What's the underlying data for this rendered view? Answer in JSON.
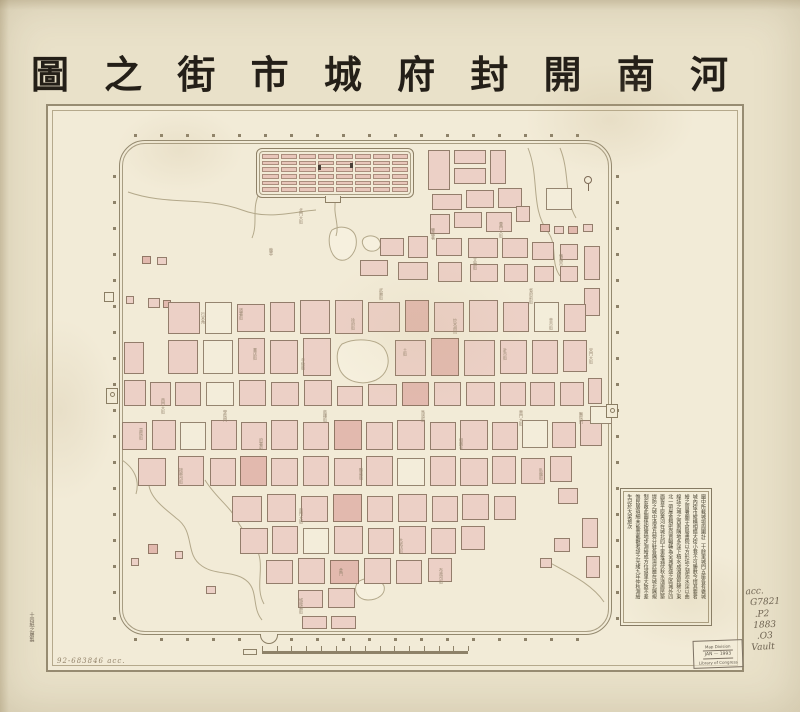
{
  "title": {
    "text": "河南開封府城市街之圖",
    "display": "圖 之 街 市 城 府 封 開 南 河"
  },
  "annotations": {
    "accession": "92-683846   acc.",
    "maker_note": "十四紙之屠製",
    "catalog": [
      "acc.",
      "G7821",
      ".P2",
      "1883",
      ".O3",
      "Vault"
    ]
  },
  "stamp": {
    "line1": "Map Division",
    "line2": "JAN — 1993",
    "line3": "Library of Congress"
  },
  "colors": {
    "sheet": "#e9e1c9",
    "map_paper": "#f2ebd7",
    "frame": "#978c72",
    "wall": "#93886e",
    "block_pink": "#ecd0c6",
    "block_dark": "#e2b9ae",
    "water": "#b3a88a",
    "ink": "#241f18",
    "pencil": "#6e6352"
  },
  "legend": {
    "columns": [
      "圖中所載城垣周圍計二十餘里城門五座各有甕城",
      "城內街市縱橫相錯大街小巷不可勝數今擇其要者",
      "繪之官署廟宇倉局書院以方形誌之湖池水窪以曲",
      "線誌之城之西南隅地多窪下積水成湖居民稀少東",
      "北一帶屋舍稠密商賈輻輳為全城繁盛之區城外四",
      "面皆平原黃河在城北四十里每遇伏秋水漲居民築",
      "堤防之城中滿漢兵營分駐各隅演武廳在城北隅規",
      "制宏敞此圖係按實地步測繪成方位道里大致不差",
      "惟民居瑣細未能悉載觀者諒之光緒九年仲秋測繪",
      "生記於大梁旅次"
    ]
  },
  "map": {
    "blocks": [
      [
        428,
        150,
        22,
        40
      ],
      [
        454,
        150,
        32,
        14
      ],
      [
        454,
        168,
        32,
        16
      ],
      [
        490,
        150,
        16,
        34
      ],
      [
        432,
        194,
        30,
        16
      ],
      [
        466,
        190,
        28,
        18
      ],
      [
        498,
        188,
        24,
        20
      ],
      [
        454,
        212,
        28,
        16
      ],
      [
        430,
        214,
        20,
        20
      ],
      [
        486,
        212,
        26,
        20
      ],
      [
        516,
        206,
        14,
        16
      ],
      [
        540,
        224,
        10,
        8,
        1
      ],
      [
        554,
        226,
        10,
        8
      ],
      [
        568,
        226,
        10,
        8,
        1
      ],
      [
        583,
        224,
        10,
        8
      ],
      [
        546,
        188,
        26,
        22,
        2
      ],
      [
        380,
        238,
        24,
        18
      ],
      [
        408,
        236,
        20,
        22
      ],
      [
        360,
        260,
        28,
        16
      ],
      [
        398,
        262,
        30,
        18
      ],
      [
        436,
        238,
        26,
        18
      ],
      [
        438,
        262,
        24,
        20
      ],
      [
        468,
        238,
        30,
        20
      ],
      [
        470,
        264,
        28,
        18
      ],
      [
        502,
        238,
        26,
        20
      ],
      [
        504,
        264,
        24,
        18
      ],
      [
        532,
        242,
        22,
        18
      ],
      [
        534,
        266,
        20,
        16
      ],
      [
        560,
        244,
        18,
        16
      ],
      [
        560,
        266,
        18,
        16
      ],
      [
        584,
        246,
        16,
        34
      ],
      [
        584,
        288,
        16,
        28
      ],
      [
        142,
        256,
        9,
        8,
        1
      ],
      [
        157,
        257,
        10,
        8
      ],
      [
        126,
        296,
        8,
        8
      ],
      [
        148,
        298,
        12,
        10
      ],
      [
        163,
        300,
        8,
        8,
        1
      ],
      [
        168,
        302,
        32,
        32
      ],
      [
        205,
        302,
        27,
        32,
        2
      ],
      [
        237,
        304,
        28,
        28
      ],
      [
        270,
        302,
        25,
        30
      ],
      [
        300,
        300,
        30,
        34
      ],
      [
        335,
        300,
        28,
        34
      ],
      [
        368,
        302,
        32,
        30
      ],
      [
        405,
        300,
        24,
        32,
        1
      ],
      [
        434,
        302,
        30,
        30
      ],
      [
        469,
        300,
        29,
        32
      ],
      [
        503,
        302,
        26,
        30
      ],
      [
        534,
        302,
        25,
        30,
        2
      ],
      [
        564,
        304,
        22,
        28
      ],
      [
        168,
        340,
        30,
        34
      ],
      [
        203,
        340,
        30,
        34,
        2
      ],
      [
        238,
        338,
        27,
        36
      ],
      [
        270,
        340,
        28,
        34
      ],
      [
        303,
        338,
        28,
        38
      ],
      [
        395,
        340,
        31,
        36
      ],
      [
        431,
        338,
        28,
        38,
        1
      ],
      [
        464,
        340,
        31,
        36
      ],
      [
        500,
        340,
        27,
        34
      ],
      [
        532,
        340,
        26,
        34
      ],
      [
        563,
        340,
        24,
        32
      ],
      [
        124,
        342,
        20,
        32
      ],
      [
        124,
        380,
        22,
        26
      ],
      [
        150,
        382,
        21,
        24
      ],
      [
        175,
        382,
        26,
        24
      ],
      [
        206,
        382,
        28,
        24,
        2
      ],
      [
        239,
        380,
        27,
        26
      ],
      [
        271,
        382,
        28,
        24
      ],
      [
        304,
        380,
        28,
        26
      ],
      [
        337,
        386,
        26,
        20
      ],
      [
        368,
        384,
        29,
        22
      ],
      [
        402,
        382,
        27,
        24,
        1
      ],
      [
        434,
        382,
        27,
        24
      ],
      [
        466,
        382,
        29,
        24
      ],
      [
        500,
        382,
        26,
        24
      ],
      [
        530,
        382,
        25,
        24
      ],
      [
        560,
        382,
        24,
        24
      ],
      [
        588,
        378,
        14,
        26
      ],
      [
        122,
        422,
        25,
        28
      ],
      [
        152,
        420,
        24,
        30
      ],
      [
        180,
        422,
        26,
        28,
        2
      ],
      [
        211,
        420,
        26,
        30
      ],
      [
        241,
        422,
        26,
        28
      ],
      [
        271,
        420,
        27,
        30
      ],
      [
        303,
        422,
        26,
        28
      ],
      [
        334,
        420,
        28,
        30,
        1
      ],
      [
        366,
        422,
        27,
        28
      ],
      [
        397,
        420,
        28,
        30
      ],
      [
        430,
        422,
        26,
        28
      ],
      [
        460,
        420,
        28,
        30
      ],
      [
        492,
        422,
        26,
        28
      ],
      [
        522,
        420,
        26,
        28,
        2
      ],
      [
        552,
        422,
        24,
        26
      ],
      [
        580,
        420,
        22,
        26
      ],
      [
        138,
        458,
        28,
        28
      ],
      [
        178,
        456,
        26,
        30
      ],
      [
        210,
        458,
        26,
        28
      ],
      [
        240,
        456,
        27,
        30,
        1
      ],
      [
        271,
        458,
        27,
        28
      ],
      [
        303,
        456,
        26,
        30
      ],
      [
        334,
        458,
        28,
        28
      ],
      [
        366,
        456,
        27,
        30
      ],
      [
        397,
        458,
        28,
        28,
        2
      ],
      [
        430,
        456,
        26,
        30
      ],
      [
        460,
        458,
        28,
        28
      ],
      [
        492,
        456,
        24,
        28
      ],
      [
        521,
        458,
        24,
        26
      ],
      [
        550,
        456,
        22,
        26
      ],
      [
        232,
        496,
        30,
        26
      ],
      [
        267,
        494,
        29,
        28
      ],
      [
        301,
        496,
        27,
        26
      ],
      [
        333,
        494,
        29,
        28,
        1
      ],
      [
        367,
        496,
        26,
        26
      ],
      [
        398,
        494,
        29,
        28
      ],
      [
        432,
        496,
        26,
        26
      ],
      [
        462,
        494,
        27,
        26
      ],
      [
        494,
        496,
        22,
        24
      ],
      [
        240,
        528,
        28,
        26
      ],
      [
        272,
        526,
        26,
        28
      ],
      [
        303,
        528,
        26,
        26,
        2
      ],
      [
        334,
        526,
        29,
        28
      ],
      [
        368,
        528,
        26,
        26
      ],
      [
        399,
        526,
        27,
        28
      ],
      [
        431,
        528,
        25,
        26
      ],
      [
        461,
        526,
        24,
        24
      ],
      [
        266,
        560,
        27,
        24
      ],
      [
        298,
        558,
        27,
        26
      ],
      [
        330,
        560,
        29,
        24,
        1
      ],
      [
        364,
        558,
        27,
        26
      ],
      [
        396,
        560,
        26,
        24
      ],
      [
        428,
        558,
        24,
        24
      ],
      [
        298,
        590,
        25,
        18
      ],
      [
        328,
        588,
        27,
        20
      ],
      [
        302,
        616,
        25,
        13
      ],
      [
        331,
        616,
        25,
        13
      ],
      [
        148,
        544,
        10,
        10,
        1
      ],
      [
        175,
        551,
        8,
        8
      ],
      [
        131,
        558,
        8,
        8
      ],
      [
        206,
        586,
        10,
        8
      ],
      [
        558,
        488,
        20,
        16
      ],
      [
        582,
        518,
        16,
        30
      ],
      [
        554,
        538,
        16,
        14
      ],
      [
        540,
        558,
        12,
        10
      ],
      [
        586,
        556,
        14,
        22
      ],
      [
        590,
        406,
        22,
        18,
        2
      ]
    ],
    "street_labels": [
      {
        "x": 298,
        "y": 208,
        "t": "北門大街"
      },
      {
        "x": 268,
        "y": 248,
        "t": "龍亭"
      },
      {
        "x": 430,
        "y": 228,
        "t": "雙龍巷"
      },
      {
        "x": 498,
        "y": 222,
        "t": "曹門大街"
      },
      {
        "x": 558,
        "y": 254,
        "t": "鵓鴿市"
      },
      {
        "x": 200,
        "y": 312,
        "t": "行宮角"
      },
      {
        "x": 252,
        "y": 348,
        "t": "書店街"
      },
      {
        "x": 300,
        "y": 358,
        "t": "寺後街"
      },
      {
        "x": 350,
        "y": 318,
        "t": "徐府街"
      },
      {
        "x": 402,
        "y": 348,
        "t": "土街"
      },
      {
        "x": 452,
        "y": 318,
        "t": "炒米胡同"
      },
      {
        "x": 502,
        "y": 348,
        "t": "針市街"
      },
      {
        "x": 548,
        "y": 318,
        "t": "草市街"
      },
      {
        "x": 588,
        "y": 348,
        "t": "宋門大街"
      },
      {
        "x": 160,
        "y": 398,
        "t": "西門大街"
      },
      {
        "x": 222,
        "y": 410,
        "t": "學院門"
      },
      {
        "x": 322,
        "y": 410,
        "t": "鼓樓街"
      },
      {
        "x": 420,
        "y": 410,
        "t": "馬道街"
      },
      {
        "x": 518,
        "y": 410,
        "t": "東門大街"
      },
      {
        "x": 578,
        "y": 412,
        "t": "醫院門"
      },
      {
        "x": 258,
        "y": 438,
        "t": "府署前"
      },
      {
        "x": 358,
        "y": 468,
        "t": "縣前街"
      },
      {
        "x": 458,
        "y": 438,
        "t": "相國寺"
      },
      {
        "x": 538,
        "y": 468,
        "t": "臥龍街"
      },
      {
        "x": 298,
        "y": 508,
        "t": "南門大街"
      },
      {
        "x": 398,
        "y": 538,
        "t": "大紙坊街"
      },
      {
        "x": 338,
        "y": 568,
        "t": "倉門"
      },
      {
        "x": 438,
        "y": 568,
        "t": "布政司街"
      },
      {
        "x": 298,
        "y": 598,
        "t": "城隍廟街"
      },
      {
        "x": 178,
        "y": 468,
        "t": "按察司街"
      },
      {
        "x": 138,
        "y": 428,
        "t": "貢院街"
      },
      {
        "x": 238,
        "y": 308,
        "t": "道署街"
      },
      {
        "x": 472,
        "y": 258,
        "t": "文廟街"
      },
      {
        "x": 378,
        "y": 288,
        "t": "武廟街"
      },
      {
        "x": 528,
        "y": 288,
        "t": "省府前街"
      }
    ],
    "lakes": [
      "M342,344 C354,338 376,338 384,348 C392,360 388,374 376,380 C362,386 346,382 340,370 C336,360 336,350 342,344 Z",
      "M332,230 C342,224 354,228 356,238 C358,250 350,262 340,260 C330,258 326,238 332,230 Z",
      "M364,238 C370,234 378,236 380,242 C382,248 376,252 370,251 C364,250 360,242 364,238 Z",
      "M358,582 C366,576 380,578 384,586 C386,594 378,600 368,600 C358,600 352,590 358,582 Z"
    ],
    "streams": [
      "M128,192 C168,206 204,196 242,210 C268,220 292,212 316,210",
      "M336,198 C332,214 340,224 336,236",
      "M528,148 C540,178 530,208 548,232 C558,246 550,262 560,276",
      "M560,148 C570,172 564,198 576,218",
      "M152,468 C140,492 162,506 176,518 C196,532 184,554 202,566 C216,576 236,570 248,582 C258,592 252,608 262,620",
      "M205,480 C216,498 230,506 238,522 C247,538 258,544 260,560 C262,574 256,590 264,604",
      "M545,560 C570,574 592,584 604,602",
      "M122,460 C134,468 140,480 136,494",
      "M258,196 C252,210 258,224 252,238"
    ],
    "scale_ticks": 15
  }
}
